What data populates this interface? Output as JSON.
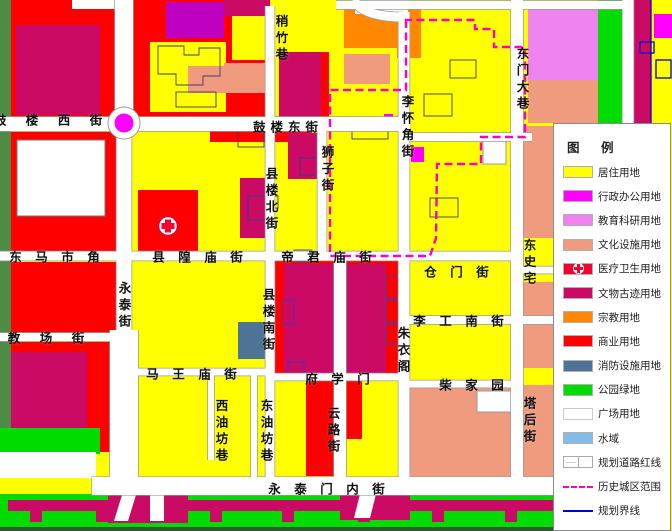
{
  "palette": {
    "residential": "#FFFF00",
    "admin": "#FF00FF",
    "education": "#EE82EE",
    "culture": "#F09B7E",
    "medical": "#F5002F",
    "heritage": "#CB0A66",
    "religion": "#FF8800",
    "commercial": "#FF0000",
    "fire": "#4F7396",
    "park": "#00DB00",
    "plaza": "#FFFFFF",
    "water": "#85BBE8",
    "historic": "#FF00BF",
    "boundary": "#0000CC",
    "purple": "#C000C0",
    "olive": "#4E8C46",
    "darkedge": "#2E5B2E"
  },
  "legend": {
    "title": "图  例",
    "items": [
      {
        "label": "居住用地",
        "key": "residential",
        "type": "fill"
      },
      {
        "label": "行政办公用地",
        "key": "admin",
        "type": "fill"
      },
      {
        "label": "教育科研用地",
        "key": "education",
        "type": "fill"
      },
      {
        "label": "文化设施用地",
        "key": "culture",
        "type": "fill"
      },
      {
        "label": "医疗卫生用地",
        "key": "medical",
        "type": "medical"
      },
      {
        "label": "文物古迹用地",
        "key": "heritage",
        "type": "fill"
      },
      {
        "label": "宗教用地",
        "key": "religion",
        "type": "fill"
      },
      {
        "label": "商业用地",
        "key": "commercial",
        "type": "fill"
      },
      {
        "label": "消防设施用地",
        "key": "fire",
        "type": "fill"
      },
      {
        "label": "公园绿地",
        "key": "park",
        "type": "fill"
      },
      {
        "label": "广场用地",
        "key": "plaza",
        "type": "fill"
      },
      {
        "label": "水域",
        "key": "water",
        "type": "fill"
      },
      {
        "label": "规划道路红线",
        "key": "plaza",
        "type": "road"
      },
      {
        "label": "历史城区范围",
        "key": "historic",
        "type": "dash"
      },
      {
        "label": "规划界线",
        "key": "boundary",
        "type": "line"
      }
    ]
  },
  "map": {
    "top_fragment": "朝 阳 街",
    "street_labels": [
      {
        "text": "鼓 楼 西 街"
      },
      {
        "text": "鼓楼东街"
      },
      {
        "text": "稍竹巷"
      },
      {
        "text": "东门大巷"
      },
      {
        "text": "李怀角街"
      },
      {
        "text": "狮子街"
      },
      {
        "text": "县楼北街"
      },
      {
        "text": "东 马 市 角"
      },
      {
        "text": "县 隍 庙 街"
      },
      {
        "text": "帝 君 庙 街"
      },
      {
        "text": "仓 门 街"
      },
      {
        "text": "东史宅"
      },
      {
        "text": "永泰街"
      },
      {
        "text": "县楼南街"
      },
      {
        "text": "李 工 南 街"
      },
      {
        "text": "朱衣阁"
      },
      {
        "text": "教 场 街"
      },
      {
        "text": "马 王 庙 街"
      },
      {
        "text": "府 学 门"
      },
      {
        "text": "柴 家 园"
      },
      {
        "text": "西油坊巷"
      },
      {
        "text": "东油坊巷"
      },
      {
        "text": "云路街"
      },
      {
        "text": "塔后街"
      },
      {
        "text": "永 泰 门 内 街"
      }
    ]
  }
}
